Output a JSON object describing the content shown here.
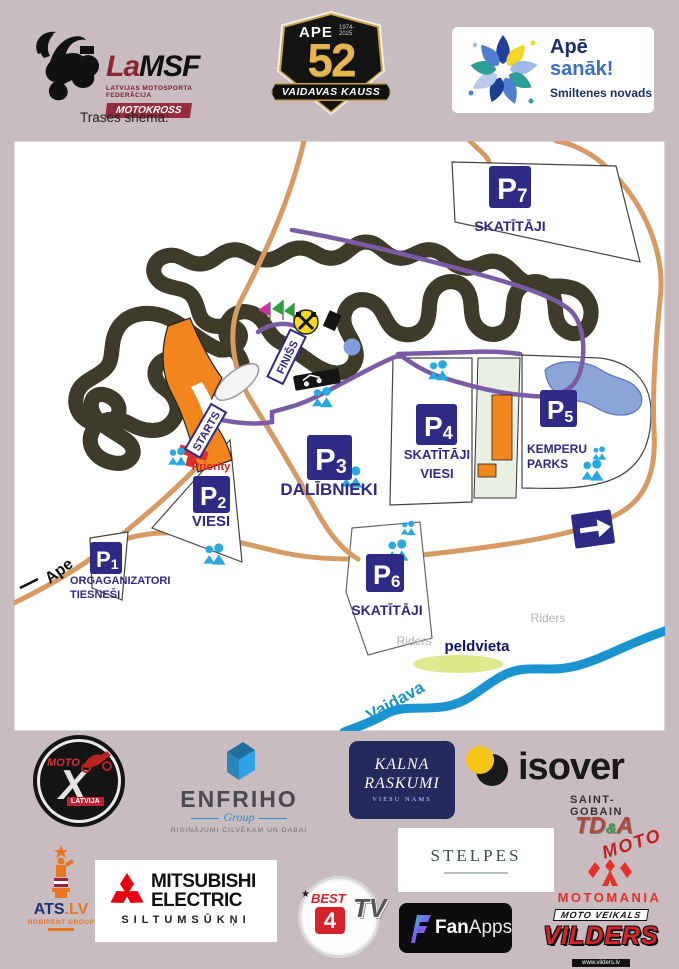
{
  "colors": {
    "background_mauve": "#c8bcc0",
    "accent_navy": "#2f2a85",
    "track_yellow": "#f2e156",
    "path_purple": "#7b5ba6",
    "road_tan": "#d79a63",
    "people_blue": "#29a9e0",
    "river_blue": "#1b93d0",
    "start_orange": "#f2861d",
    "brand_red": "#d5232a"
  },
  "header": {
    "lamsf": {
      "la": "La",
      "msf": "MSF",
      "federation": "LATVIJAS MOTOSPORTA FEDERĀCIJA",
      "division": "MOTOKROSS"
    },
    "badge": {
      "ape": "APE",
      "years": "1974- 2025",
      "number": "52",
      "banner": "VAIDAVAS KAUSS"
    },
    "apesanak": {
      "line1": "Apē",
      "line2": "sanāk!",
      "line3": "Smiltenes novads"
    }
  },
  "map": {
    "title": "Trases shēma:",
    "markers": {
      "p1": {
        "code": "P",
        "num": "1"
      },
      "p2": {
        "code": "P",
        "num": "2"
      },
      "p3": {
        "code": "P",
        "num": "3"
      },
      "p4": {
        "code": "P",
        "num": "4"
      },
      "p5": {
        "code": "P",
        "num": "5"
      },
      "p6": {
        "code": "P",
        "num": "6"
      },
      "p7": {
        "code": "P",
        "num": "7"
      }
    },
    "captions": {
      "p7": "SKATĪTĀJI",
      "p6": "SKATĪTĀJI",
      "p5_line1": "KEMPERU",
      "p5_line2": "PARKS",
      "p4_line1": "SKATĪTĀJI",
      "p4_line2": "VIESI",
      "p3": "DALĪBNIEKI",
      "p2": "VIESI",
      "p2_priority": "Priority",
      "p1_line1": "ORGAGANIZATORI",
      "p1_line2": "TIESNEŠI",
      "riders": "Riders",
      "peldvieta": "peldvieta",
      "vaidava": "Vaidava",
      "ape_road": "Ape",
      "starts": "STARTS",
      "finiss": "FINIŠS"
    }
  },
  "sponsors": {
    "motox": {
      "moto": "MOTO",
      "x": "X",
      "latvija": "LATVIJA"
    },
    "enfriho": {
      "name": "ENFRIHO",
      "group": "Group",
      "tagline": "RISINĀJUMI CILVĒKAM UN DABAI"
    },
    "kalna": {
      "line1": "KALNA",
      "line2": "RASKUMI",
      "line3": "VIESU NAMS"
    },
    "isover": {
      "name": "isover",
      "parent": "SAINT-GOBAIN"
    },
    "tda": {
      "name": "TD",
      "amp": "&",
      "a": "A",
      "moto": "MOTO"
    },
    "ats": {
      "name": "ATS",
      "lv": ".LV",
      "group": "ROBIRENT GROUP"
    },
    "mitsubishi": {
      "line1": "MITSUBISHI",
      "line2": "ELECTRIC",
      "line3": "SILTUMSŪKŅI"
    },
    "best4": {
      "best": "BEST",
      "star": "★",
      "four": "4",
      "tv": "TV"
    },
    "stelpes": {
      "name": "STELPES"
    },
    "fanapps": {
      "fan": "Fan",
      "apps": "Apps"
    },
    "motomania": {
      "name": "MOTOMANIA"
    },
    "vilders": {
      "shop": "MOTO VEIKALS",
      "name": "VILDERS",
      "url": "www.vilders.lv"
    }
  }
}
